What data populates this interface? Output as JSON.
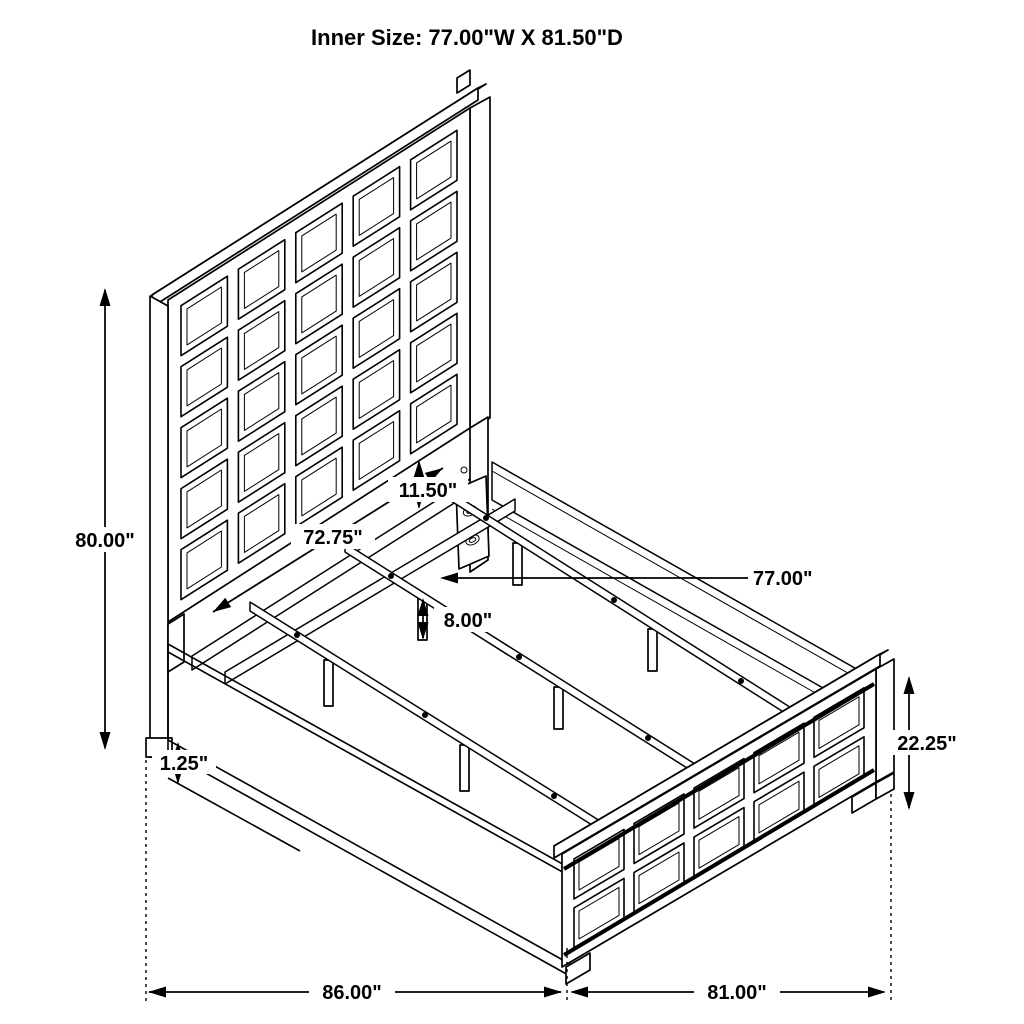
{
  "title": "Inner Size: 77.00\"W X 81.50\"D",
  "colors": {
    "line": "#000000",
    "background": "#ffffff"
  },
  "dimensions": {
    "headboard_height": "80.00\"",
    "headboard_width": "72.75\"",
    "panel_to_rail_gap": "11.50\"",
    "inner_width": "77.00\"",
    "slat_leg_height": "8.00\"",
    "side_rail_lip": "1.25\"",
    "footboard_height": "22.25\"",
    "length_headboard_section": "86.00\"",
    "length_footboard_section": "81.00\""
  }
}
